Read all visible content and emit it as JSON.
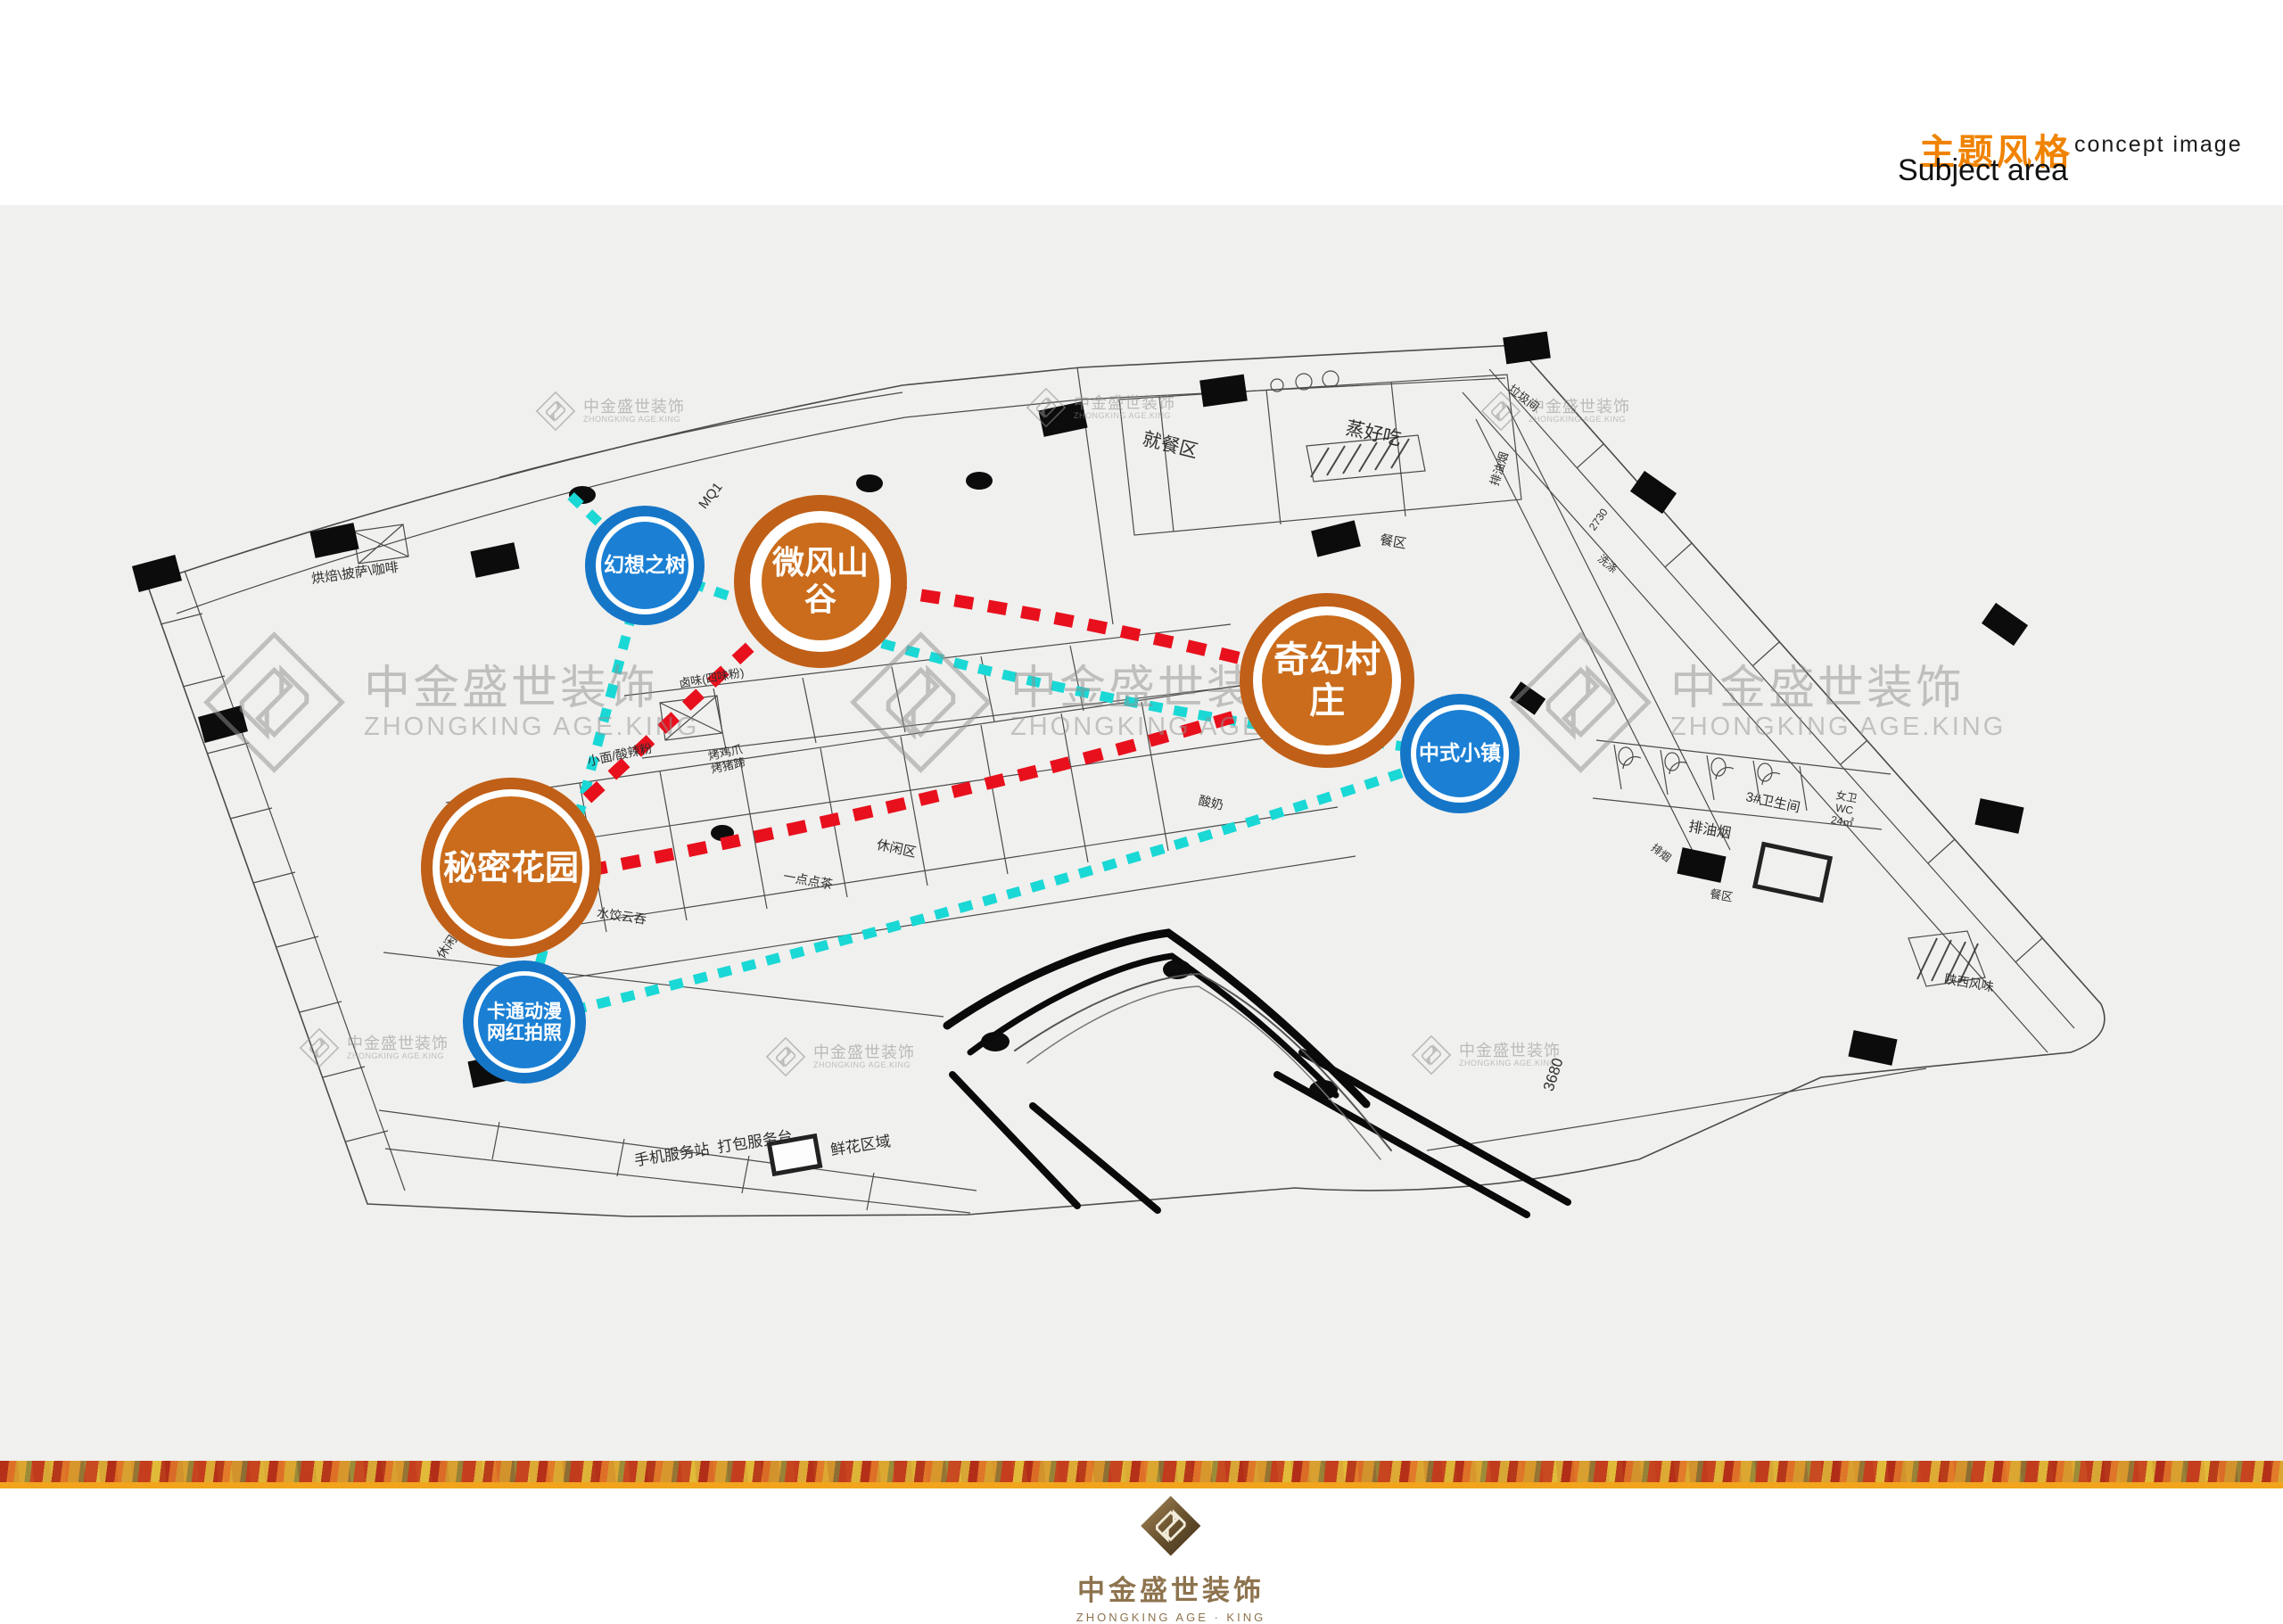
{
  "header": {
    "title_cn": "主题风格",
    "title_en": "concept image",
    "subtitle": "Subject area"
  },
  "watermark": {
    "cn": "中金盛世装饰",
    "en": "ZHONGKING AGE.KING"
  },
  "footer": {
    "logo_cn": "中金盛世装饰",
    "logo_en": "ZHONGKING AGE · KING"
  },
  "colors": {
    "header_accent": "#f08300",
    "bubble_orange": "#ca6c1b",
    "bubble_blue": "#1b80d4",
    "dash_red": "#e8101d",
    "dash_cyan": "#1ad8d5",
    "strip_gold": "#f2a41c",
    "stage_gray": "#f0f0ee"
  },
  "bubbles": [
    {
      "label": "微风山谷",
      "type": "orange"
    },
    {
      "label": "奇幻村庄",
      "type": "orange"
    },
    {
      "label": "秘密花园",
      "type": "orange"
    },
    {
      "label": "幻想之树",
      "type": "blue"
    },
    {
      "label": "中式小镇",
      "type": "blue"
    },
    {
      "label": "卡通动漫\n网红拍照",
      "type": "blue"
    }
  ],
  "plan_labels": [
    {
      "text": "烘焙\\披萨\\咖啡"
    },
    {
      "text": "MQ1"
    },
    {
      "text": "就餐区"
    },
    {
      "text": "蒸好吃"
    },
    {
      "text": "餐区"
    },
    {
      "text": "垃圾间"
    },
    {
      "text": "排油烟"
    },
    {
      "text": "2730"
    },
    {
      "text": "卤味(四味粉)"
    },
    {
      "text": "小面/酸辣粉"
    },
    {
      "text": "烤鸡爪\n烤猪蹄"
    },
    {
      "text": "酸奶"
    },
    {
      "text": "休闲区"
    },
    {
      "text": "一点点茶"
    },
    {
      "text": "水饺云吞"
    },
    {
      "text": "休闲区"
    },
    {
      "text": "排油烟"
    },
    {
      "text": "排烟"
    },
    {
      "text": "3#卫生间"
    },
    {
      "text": "女卫\nWC\n24㎡"
    },
    {
      "text": "餐区"
    },
    {
      "text": "陕西风味"
    },
    {
      "text": "洗涤"
    },
    {
      "text": "手机服务站  打包服务台"
    },
    {
      "text": "鲜花区域"
    },
    {
      "text": "3680"
    }
  ]
}
